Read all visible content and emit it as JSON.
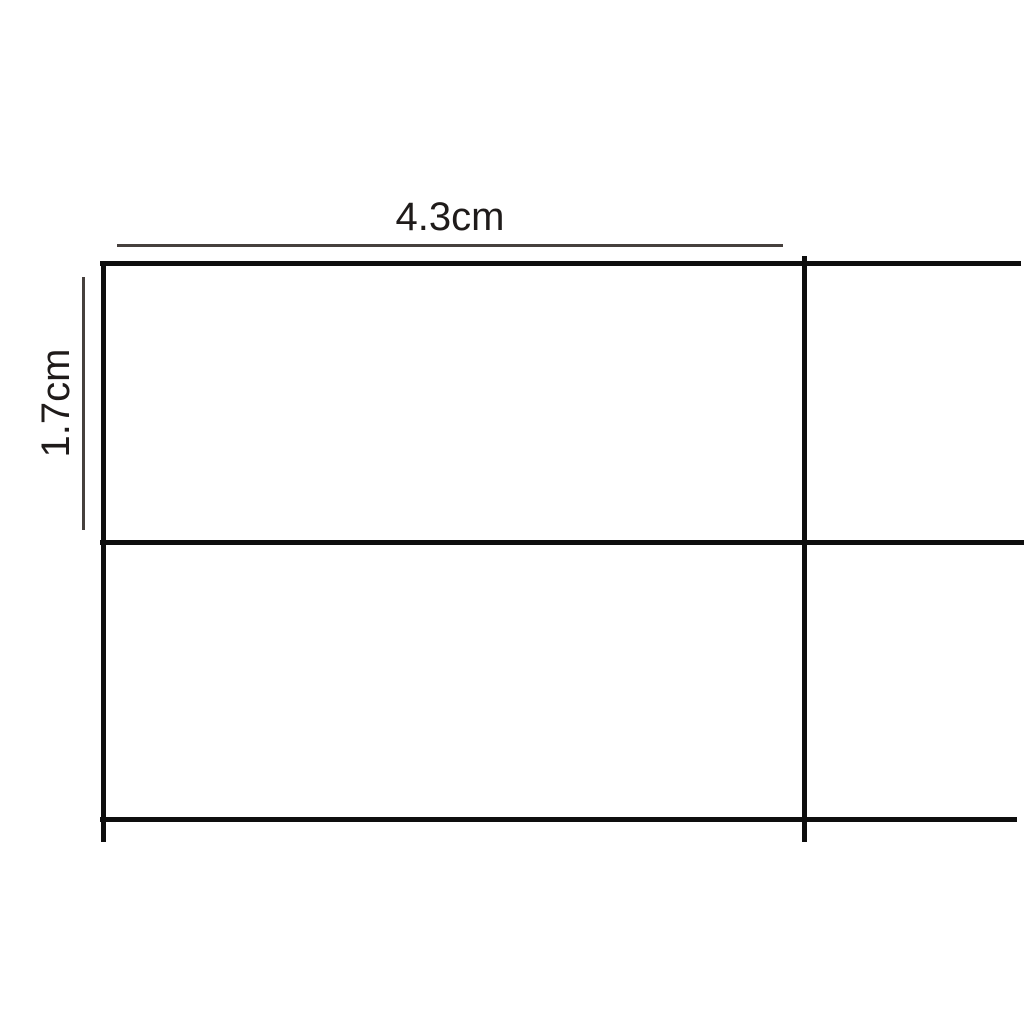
{
  "diagram": {
    "type": "dimensioned-grid-drawing",
    "description": "Grid of black lines (table cells) with two dimension annotations",
    "width_dimension": {
      "label": "4.3cm",
      "orientation": "horizontal"
    },
    "height_dimension": {
      "label": "1.7cm",
      "orientation": "vertical"
    },
    "colors": {
      "background": "#ffffff",
      "grid_line": "#0e0e0e",
      "dimension_line": "#46403d",
      "text": "#1f1b1a"
    }
  }
}
